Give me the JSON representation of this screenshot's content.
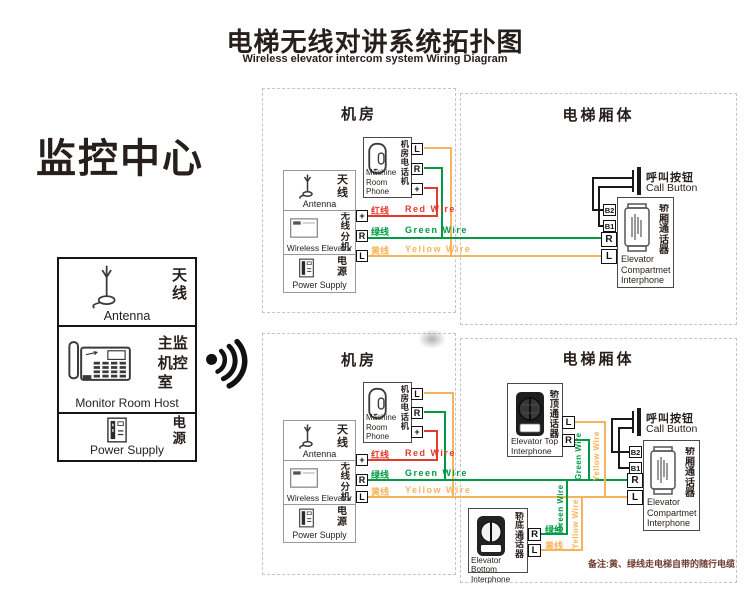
{
  "header": {
    "title_cn": "电梯无线对讲系统拓扑图",
    "title_en": "Wireless elevator intercom system Wiring Diagram"
  },
  "monitor_center": {
    "title": "监控中心",
    "antenna_cn": "天线",
    "antenna_en": "Antenna",
    "host_cn": "主监机控室",
    "host_en": "Monitor Room Host",
    "power_cn": "电源",
    "power_en": "Power Supply"
  },
  "section_labels": {
    "machine_room": "机房",
    "elevator_body": "电梯厢体"
  },
  "machine_room": {
    "phone_cn": "机房电话机",
    "phone_en1": "Machine",
    "phone_en2": "Room Phone",
    "phone_terminals": [
      "L",
      "R",
      "+"
    ],
    "antenna_cn": "天线",
    "antenna_en": "Antenna",
    "wireless_cn": "无线分机",
    "wireless_en": "Wireless Elevator",
    "wireless_terminals": [
      "+",
      "R",
      "L"
    ],
    "power_cn": "电源",
    "power_en": "Power Supply"
  },
  "wires": {
    "red": {
      "cn": "红线",
      "en": "Red Wire",
      "color": "#e23b2e"
    },
    "green": {
      "cn": "绿线",
      "en": "Green Wire",
      "color": "#009a44"
    },
    "yellow": {
      "cn": "黄线",
      "en": "Yellow Wire",
      "color": "#f7b45c"
    }
  },
  "vertical_wire_labels": {
    "green": "Green Wire",
    "yellow": "Yellow Wire"
  },
  "call_button": {
    "cn": "呼叫按钮",
    "en": "Call Button"
  },
  "compartment_interphone": {
    "cn": "轿厢通话器",
    "en1": "Elevator",
    "en2": "Compartmet",
    "en3": "Interphone",
    "t_b2": "B2",
    "t_b1": "B1",
    "t_r": "R",
    "t_l": "L"
  },
  "top_interphone": {
    "cn": "轿顶通话器",
    "en1": "Elevator Top",
    "en2": "Interphone",
    "t_l": "L",
    "t_r": "R"
  },
  "bottom_interphone": {
    "cn": "轿底通话器",
    "en1": "Elevator Bottom",
    "en2": "Interphone",
    "t_r": "R",
    "t_l": "L",
    "r_wire_cn": "绿线",
    "l_wire_cn": "黄线"
  },
  "note": "备注:黄、绿线走电梯自带的随行电缆"
}
